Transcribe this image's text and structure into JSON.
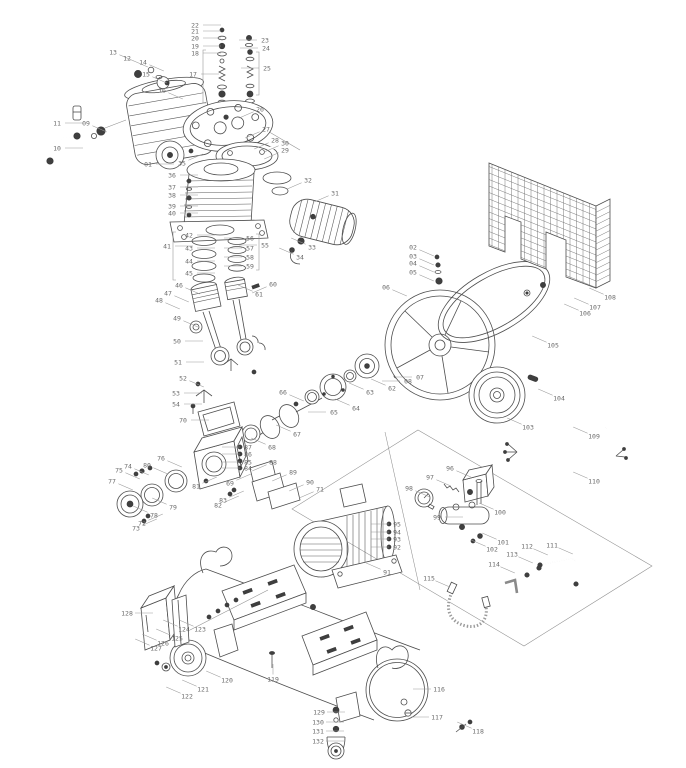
{
  "meta": {
    "doc_type": "exploded-parts-diagram",
    "subject": "belt-driven air compressor assembly",
    "canvas": {
      "width": 686,
      "height": 768
    },
    "colors": {
      "line": "#4d4d4d",
      "leader": "#9a9a9a",
      "label": "#6a6a6a",
      "dark": "#3f3f3f",
      "background": "#ffffff"
    },
    "label_count": 132
  },
  "diagram": {
    "labels": [
      {
        "n": "01",
        "x": 148,
        "y": 164,
        "d": "r"
      },
      {
        "n": "02",
        "x": 413,
        "y": 247,
        "d": "dr"
      },
      {
        "n": "03",
        "x": 413,
        "y": 256,
        "d": "dr"
      },
      {
        "n": "04",
        "x": 413,
        "y": 263,
        "d": "dr"
      },
      {
        "n": "05",
        "x": 413,
        "y": 272,
        "d": "dr"
      },
      {
        "n": "06",
        "x": 386,
        "y": 287,
        "d": "dr"
      },
      {
        "n": "07",
        "x": 420,
        "y": 377,
        "d": "l"
      },
      {
        "n": "08",
        "x": 408,
        "y": 381,
        "d": "l"
      },
      {
        "n": "09",
        "x": 86,
        "y": 123,
        "d": "dr"
      },
      {
        "n": "10",
        "x": 57,
        "y": 148,
        "d": "r"
      },
      {
        "n": "11",
        "x": 57,
        "y": 123,
        "d": "r"
      },
      {
        "n": "12",
        "x": 127,
        "y": 58,
        "d": "dr"
      },
      {
        "n": "13",
        "x": 113,
        "y": 52,
        "d": "dr"
      },
      {
        "n": "14",
        "x": 143,
        "y": 62,
        "d": "dr"
      },
      {
        "n": "15",
        "x": 146,
        "y": 74,
        "d": "dr"
      },
      {
        "n": "16",
        "x": 162,
        "y": 90,
        "d": "dr"
      },
      {
        "n": "17",
        "x": 193,
        "y": 74,
        "d": "r"
      },
      {
        "n": "18",
        "x": 195,
        "y": 53,
        "d": "r"
      },
      {
        "n": "19",
        "x": 195,
        "y": 46,
        "d": "r"
      },
      {
        "n": "20",
        "x": 195,
        "y": 38,
        "d": "r"
      },
      {
        "n": "21",
        "x": 195,
        "y": 31,
        "d": "r"
      },
      {
        "n": "22",
        "x": 195,
        "y": 25,
        "d": "r"
      },
      {
        "n": "23",
        "x": 265,
        "y": 40,
        "d": "l"
      },
      {
        "n": "24",
        "x": 266,
        "y": 48,
        "d": "l"
      },
      {
        "n": "25",
        "x": 267,
        "y": 68,
        "d": "l"
      },
      {
        "n": "26",
        "x": 260,
        "y": 109,
        "d": "dl"
      },
      {
        "n": "27",
        "x": 266,
        "y": 129,
        "d": "dl"
      },
      {
        "n": "28",
        "x": 275,
        "y": 140,
        "d": "dl"
      },
      {
        "n": "29",
        "x": 285,
        "y": 150,
        "d": "dl"
      },
      {
        "n": "30",
        "x": 285,
        "y": 143,
        "d": "dl"
      },
      {
        "n": "31",
        "x": 335,
        "y": 193,
        "d": "dl"
      },
      {
        "n": "32",
        "x": 308,
        "y": 180,
        "d": "dl"
      },
      {
        "n": "33",
        "x": 312,
        "y": 247,
        "d": "ul"
      },
      {
        "n": "34",
        "x": 300,
        "y": 257,
        "d": "ul"
      },
      {
        "n": "35",
        "x": 182,
        "y": 163,
        "d": "ur"
      },
      {
        "n": "36",
        "x": 172,
        "y": 175,
        "d": "r"
      },
      {
        "n": "37",
        "x": 172,
        "y": 187,
        "d": "r"
      },
      {
        "n": "38",
        "x": 172,
        "y": 195,
        "d": "r"
      },
      {
        "n": "39",
        "x": 172,
        "y": 206,
        "d": "r"
      },
      {
        "n": "40",
        "x": 172,
        "y": 213,
        "d": "r"
      },
      {
        "n": "41",
        "x": 167,
        "y": 246,
        "d": "r"
      },
      {
        "n": "42",
        "x": 189,
        "y": 235,
        "d": "r"
      },
      {
        "n": "43",
        "x": 189,
        "y": 248,
        "d": "r"
      },
      {
        "n": "44",
        "x": 189,
        "y": 261,
        "d": "r"
      },
      {
        "n": "45",
        "x": 189,
        "y": 273,
        "d": "r"
      },
      {
        "n": "46",
        "x": 179,
        "y": 285,
        "d": "dr"
      },
      {
        "n": "47",
        "x": 168,
        "y": 293,
        "d": "dr"
      },
      {
        "n": "48",
        "x": 159,
        "y": 300,
        "d": "dr"
      },
      {
        "n": "49",
        "x": 177,
        "y": 318,
        "d": "dr"
      },
      {
        "n": "50",
        "x": 177,
        "y": 341,
        "d": "r"
      },
      {
        "n": "51",
        "x": 178,
        "y": 362,
        "d": "r"
      },
      {
        "n": "52",
        "x": 183,
        "y": 378,
        "d": "dr"
      },
      {
        "n": "53",
        "x": 176,
        "y": 393,
        "d": "r"
      },
      {
        "n": "54",
        "x": 176,
        "y": 404,
        "d": "r"
      },
      {
        "n": "55",
        "x": 265,
        "y": 245,
        "d": "l"
      },
      {
        "n": "56",
        "x": 250,
        "y": 238,
        "d": "l"
      },
      {
        "n": "57",
        "x": 250,
        "y": 248,
        "d": "l"
      },
      {
        "n": "58",
        "x": 250,
        "y": 257,
        "d": "l"
      },
      {
        "n": "59",
        "x": 250,
        "y": 266,
        "d": "l"
      },
      {
        "n": "60",
        "x": 273,
        "y": 284,
        "d": "dl"
      },
      {
        "n": "61",
        "x": 259,
        "y": 294,
        "d": "ul"
      },
      {
        "n": "62",
        "x": 392,
        "y": 388,
        "d": "ul"
      },
      {
        "n": "63",
        "x": 370,
        "y": 392,
        "d": "ul"
      },
      {
        "n": "64",
        "x": 356,
        "y": 408,
        "d": "ul"
      },
      {
        "n": "65",
        "x": 334,
        "y": 412,
        "d": "l"
      },
      {
        "n": "66",
        "x": 283,
        "y": 392,
        "d": "dr"
      },
      {
        "n": "67",
        "x": 297,
        "y": 434,
        "d": "ul"
      },
      {
        "n": "68",
        "x": 272,
        "y": 447,
        "d": "ul"
      },
      {
        "n": "69",
        "x": 230,
        "y": 483,
        "d": "ur"
      },
      {
        "n": "70",
        "x": 183,
        "y": 420,
        "d": "r"
      },
      {
        "n": "71",
        "x": 320,
        "y": 489,
        "d": "dl"
      },
      {
        "n": "72",
        "x": 142,
        "y": 523,
        "d": "ur"
      },
      {
        "n": "73",
        "x": 136,
        "y": 528,
        "d": "ur"
      },
      {
        "n": "74",
        "x": 128,
        "y": 466,
        "d": "dr"
      },
      {
        "n": "75",
        "x": 119,
        "y": 470,
        "d": "dr"
      },
      {
        "n": "76",
        "x": 161,
        "y": 458,
        "d": "dr"
      },
      {
        "n": "77",
        "x": 112,
        "y": 481,
        "d": "dr"
      },
      {
        "n": "78",
        "x": 154,
        "y": 515,
        "d": "ul"
      },
      {
        "n": "79",
        "x": 173,
        "y": 507,
        "d": "ul"
      },
      {
        "n": "80",
        "x": 147,
        "y": 465,
        "d": "dr"
      },
      {
        "n": "81",
        "x": 196,
        "y": 486,
        "d": "ur"
      },
      {
        "n": "82",
        "x": 218,
        "y": 505,
        "d": "ur"
      },
      {
        "n": "83",
        "x": 223,
        "y": 500,
        "d": "ur"
      },
      {
        "n": "84",
        "x": 248,
        "y": 468,
        "d": "l"
      },
      {
        "n": "85",
        "x": 248,
        "y": 462,
        "d": "l"
      },
      {
        "n": "86",
        "x": 248,
        "y": 454,
        "d": "l"
      },
      {
        "n": "87",
        "x": 248,
        "y": 447,
        "d": "l"
      },
      {
        "n": "88",
        "x": 273,
        "y": 462,
        "d": "dl"
      },
      {
        "n": "89",
        "x": 293,
        "y": 472,
        "d": "dl"
      },
      {
        "n": "90",
        "x": 310,
        "y": 482,
        "d": "dl"
      },
      {
        "n": "91",
        "x": 387,
        "y": 572,
        "d": "ul"
      },
      {
        "n": "92",
        "x": 397,
        "y": 547,
        "d": "l"
      },
      {
        "n": "93",
        "x": 397,
        "y": 539,
        "d": "l"
      },
      {
        "n": "94",
        "x": 397,
        "y": 532,
        "d": "l"
      },
      {
        "n": "95",
        "x": 397,
        "y": 524,
        "d": "l"
      },
      {
        "n": "96",
        "x": 450,
        "y": 468,
        "d": "dr"
      },
      {
        "n": "97",
        "x": 430,
        "y": 477,
        "d": "dr"
      },
      {
        "n": "98",
        "x": 409,
        "y": 488,
        "d": "dr"
      },
      {
        "n": "99",
        "x": 437,
        "y": 517,
        "d": "r"
      },
      {
        "n": "100",
        "x": 500,
        "y": 512,
        "d": "ul"
      },
      {
        "n": "101",
        "x": 503,
        "y": 542,
        "d": "ul"
      },
      {
        "n": "102",
        "x": 492,
        "y": 549,
        "d": "ul"
      },
      {
        "n": "103",
        "x": 528,
        "y": 427,
        "d": "ul"
      },
      {
        "n": "104",
        "x": 559,
        "y": 398,
        "d": "ul"
      },
      {
        "n": "105",
        "x": 553,
        "y": 345,
        "d": "ul"
      },
      {
        "n": "106",
        "x": 585,
        "y": 313,
        "d": "ul"
      },
      {
        "n": "107",
        "x": 595,
        "y": 307,
        "d": "ul"
      },
      {
        "n": "108",
        "x": 610,
        "y": 297,
        "d": "ul"
      },
      {
        "n": "109",
        "x": 594,
        "y": 436,
        "d": "ul"
      },
      {
        "n": "110",
        "x": 594,
        "y": 481,
        "d": "ul"
      },
      {
        "n": "111",
        "x": 552,
        "y": 545,
        "d": "dr"
      },
      {
        "n": "112",
        "x": 527,
        "y": 546,
        "d": "dr"
      },
      {
        "n": "113",
        "x": 512,
        "y": 554,
        "d": "dr"
      },
      {
        "n": "114",
        "x": 494,
        "y": 564,
        "d": "dr"
      },
      {
        "n": "115",
        "x": 429,
        "y": 578,
        "d": "dr"
      },
      {
        "n": "116",
        "x": 439,
        "y": 689,
        "d": "l"
      },
      {
        "n": "117",
        "x": 437,
        "y": 717,
        "d": "l"
      },
      {
        "n": "118",
        "x": 478,
        "y": 731,
        "d": "ul"
      },
      {
        "n": "119",
        "x": 273,
        "y": 679,
        "d": "u"
      },
      {
        "n": "120",
        "x": 227,
        "y": 680,
        "d": "ul"
      },
      {
        "n": "121",
        "x": 203,
        "y": 689,
        "d": "ul"
      },
      {
        "n": "122",
        "x": 187,
        "y": 696,
        "d": "ul"
      },
      {
        "n": "123",
        "x": 200,
        "y": 629,
        "d": "ul"
      },
      {
        "n": "124",
        "x": 184,
        "y": 629,
        "d": "ul"
      },
      {
        "n": "125",
        "x": 177,
        "y": 638,
        "d": "ul"
      },
      {
        "n": "126",
        "x": 163,
        "y": 643,
        "d": "ul"
      },
      {
        "n": "127",
        "x": 156,
        "y": 648,
        "d": "ul"
      },
      {
        "n": "128",
        "x": 127,
        "y": 613,
        "d": "r"
      },
      {
        "n": "129",
        "x": 319,
        "y": 712,
        "d": "r"
      },
      {
        "n": "130",
        "x": 318,
        "y": 722,
        "d": "r"
      },
      {
        "n": "131",
        "x": 318,
        "y": 731,
        "d": "r"
      },
      {
        "n": "132",
        "x": 318,
        "y": 741,
        "d": "r"
      }
    ]
  }
}
